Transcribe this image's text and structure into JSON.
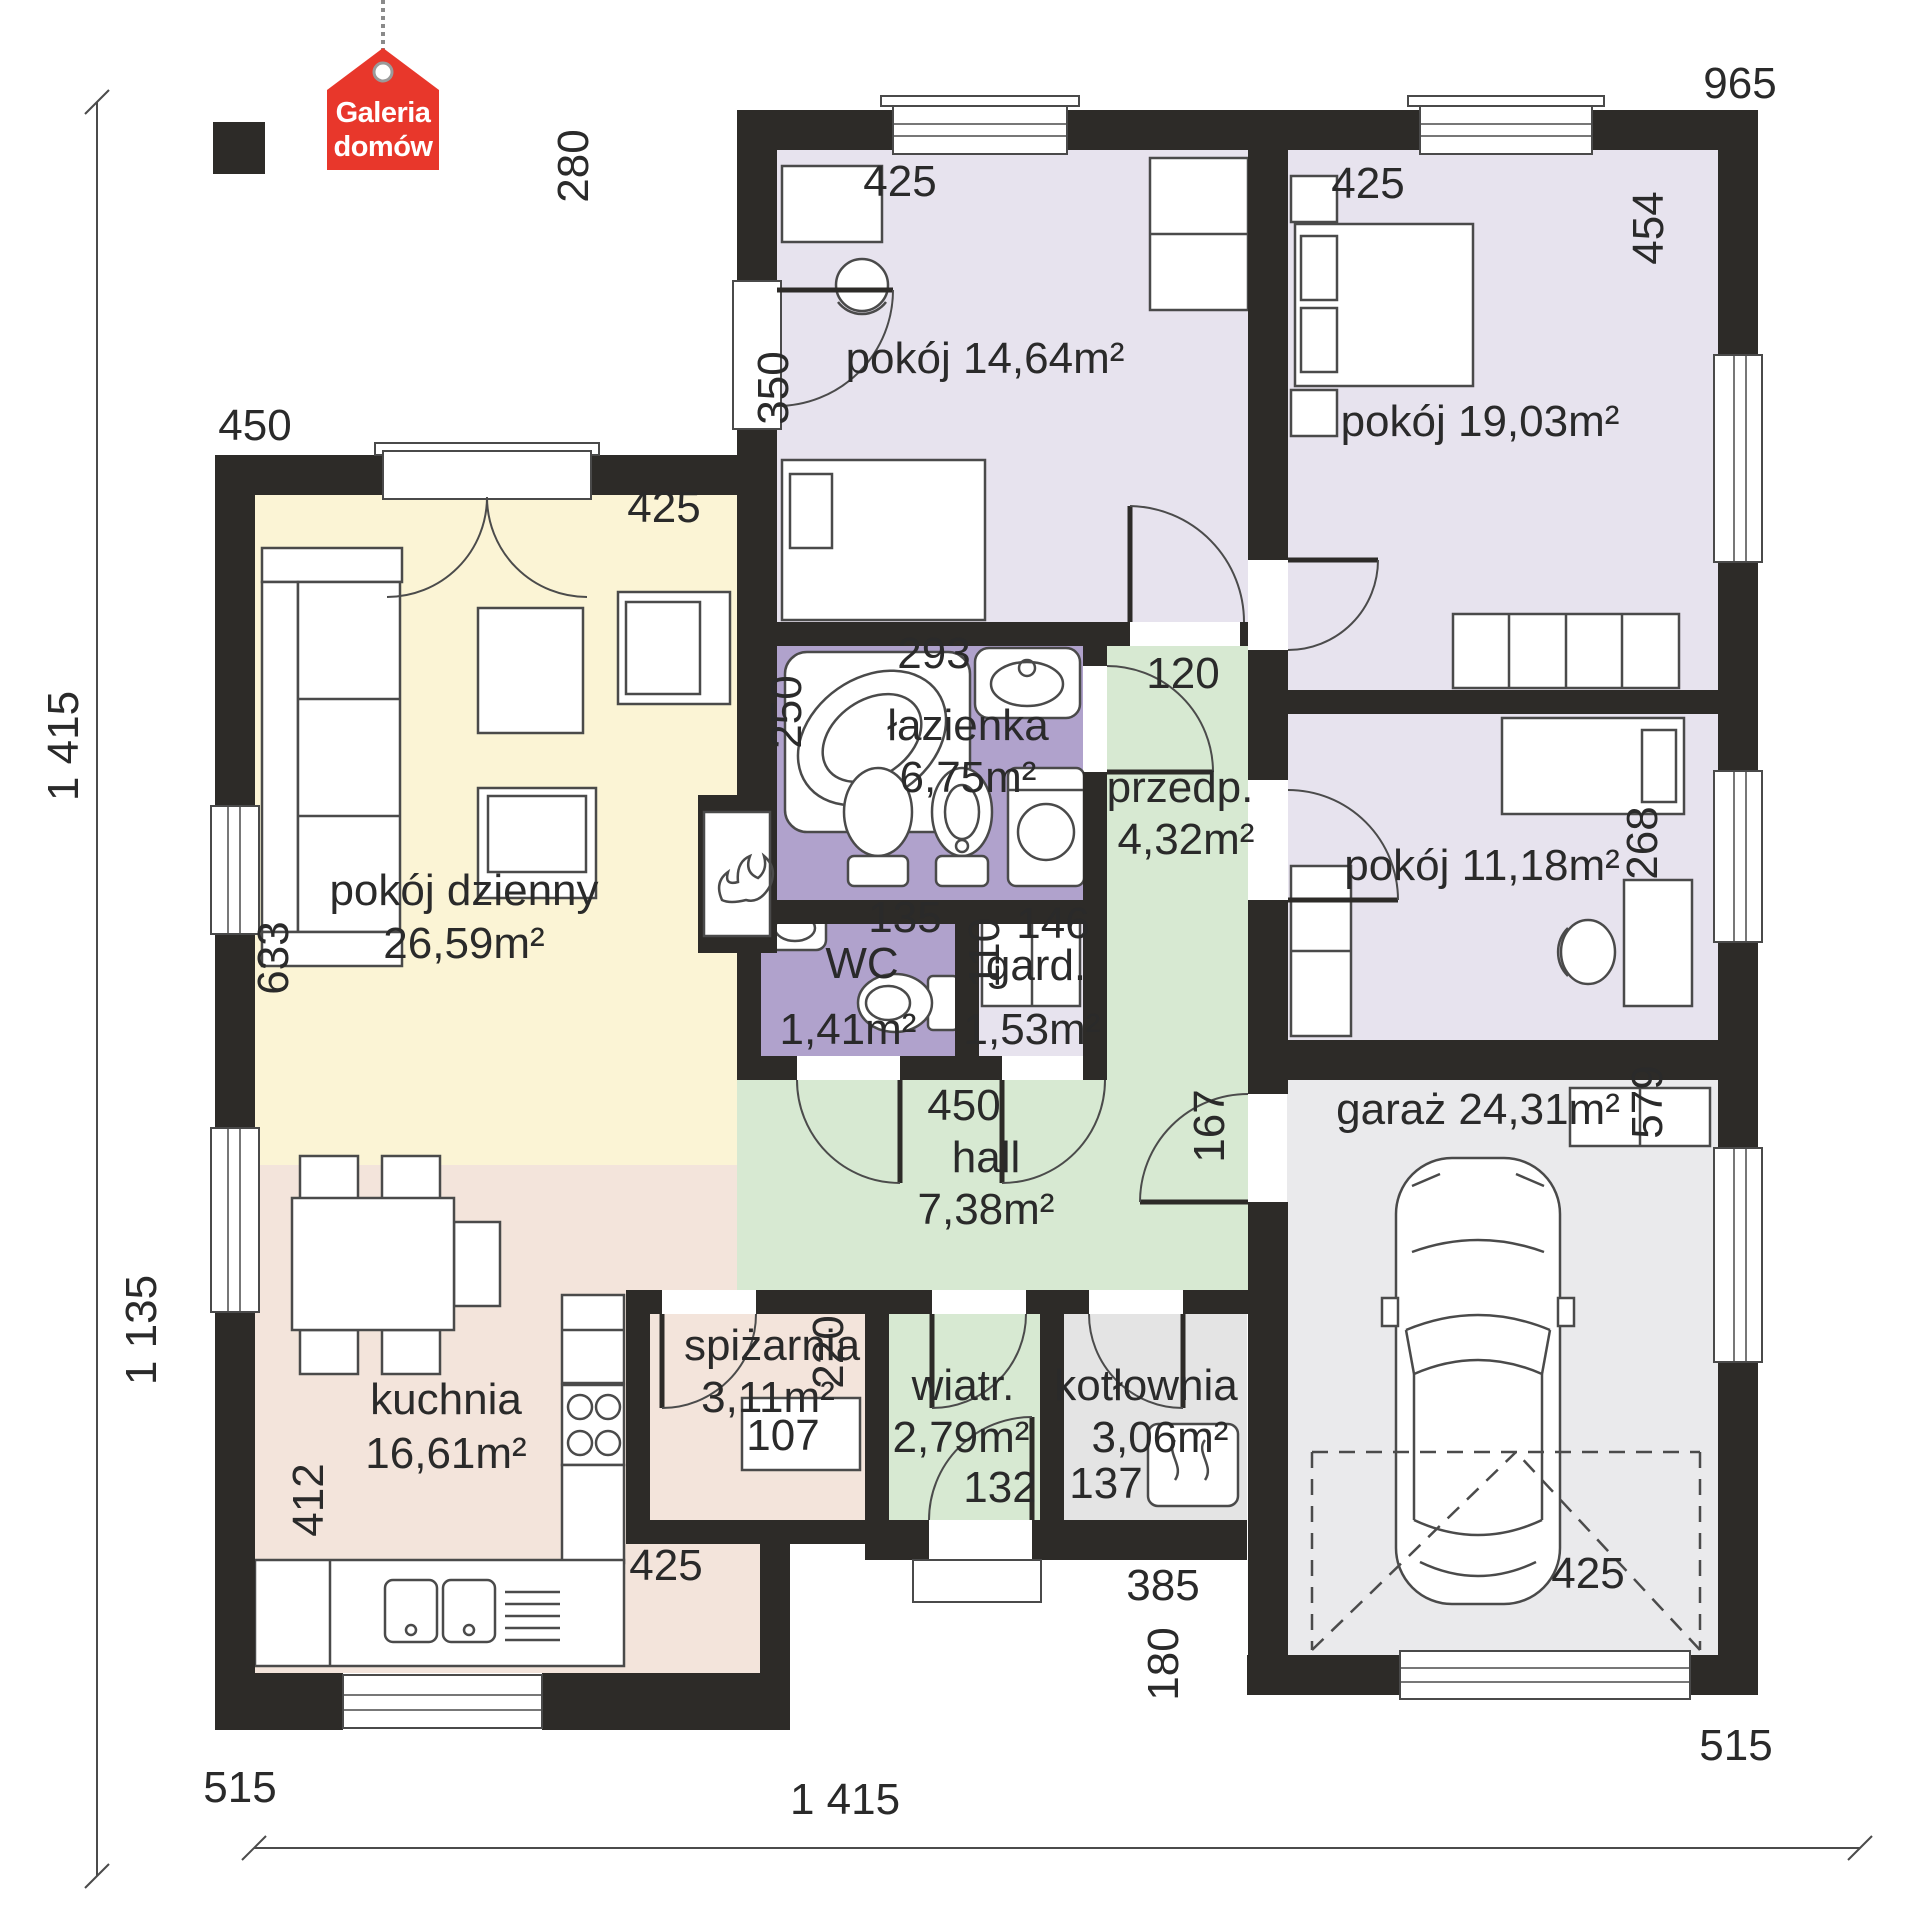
{
  "logo": {
    "line1": "Galeria",
    "line2": "domów"
  },
  "rooms": {
    "pokoj14": {
      "label": "pokój 14,64m²"
    },
    "pokoj19": {
      "label": "pokój 19,03m²"
    },
    "pokoj11": {
      "label": "pokój 11,18m²"
    },
    "living": {
      "label": "pokój dzienny",
      "area": "26,59m²"
    },
    "bathroom": {
      "label": "łazienka",
      "area": "6,75m²"
    },
    "vestibule": {
      "label": "przedp.",
      "area": "4,32m²"
    },
    "wc": {
      "label": "WC",
      "area": "1,41m²"
    },
    "wardrobe": {
      "label": "gard.",
      "area": "1,53m²"
    },
    "hall": {
      "label": "hall",
      "area": "7,38m²"
    },
    "garage": {
      "label": "garaż 24,31m²"
    },
    "pantry": {
      "label": "spiżarnia",
      "area": "3,11m²"
    },
    "windbreak": {
      "label": "wiatr.",
      "area": "2,79m²"
    },
    "boiler": {
      "label": "kotłownia",
      "area": "3,06m²"
    },
    "kitchen": {
      "label": "kuchnia",
      "area": "16,61m²"
    }
  },
  "dims": {
    "overall_left": "1 415",
    "overall_bottom": "1 415",
    "top_right": "965",
    "n280": "280",
    "p14_top": "425",
    "p14_left": "350",
    "p19_top": "425",
    "p19_right": "454",
    "living_top": "450",
    "living_inner": "425",
    "bath_w": "293",
    "bath_h": "250",
    "vest_w": "120",
    "wc_w": "135",
    "gard_h": "110",
    "gard_w": "146",
    "living_left": "633",
    "hall_w": "450",
    "hall_right": "167",
    "garage_right": "579",
    "pantry_w": "220",
    "pantry_shelf": "107",
    "windbreak_w": "132",
    "boiler_w": "137",
    "recess": "385",
    "kitchen_left": "412",
    "kitchen_bottom": "425",
    "garage_offset": "180",
    "garage_door": "425",
    "left_lower": "1 135",
    "bottom_left": "515",
    "bottom_right": "515"
  },
  "colors": {
    "wall": "#2d2b28",
    "ink": "#2a2a2a",
    "line": "#4a4a4a",
    "bedroom": "#e7e3ee",
    "bath": "#b0a2cc",
    "wardrobe_room": "#e7e3ee",
    "green": "#d7e9d2",
    "cream": "#fbf4d5",
    "kitchen_pink": "#f3e4db",
    "boiler_gray": "#e4e4e4",
    "garage_gray": "#eaeaec",
    "logo_red": "#e8372b"
  }
}
